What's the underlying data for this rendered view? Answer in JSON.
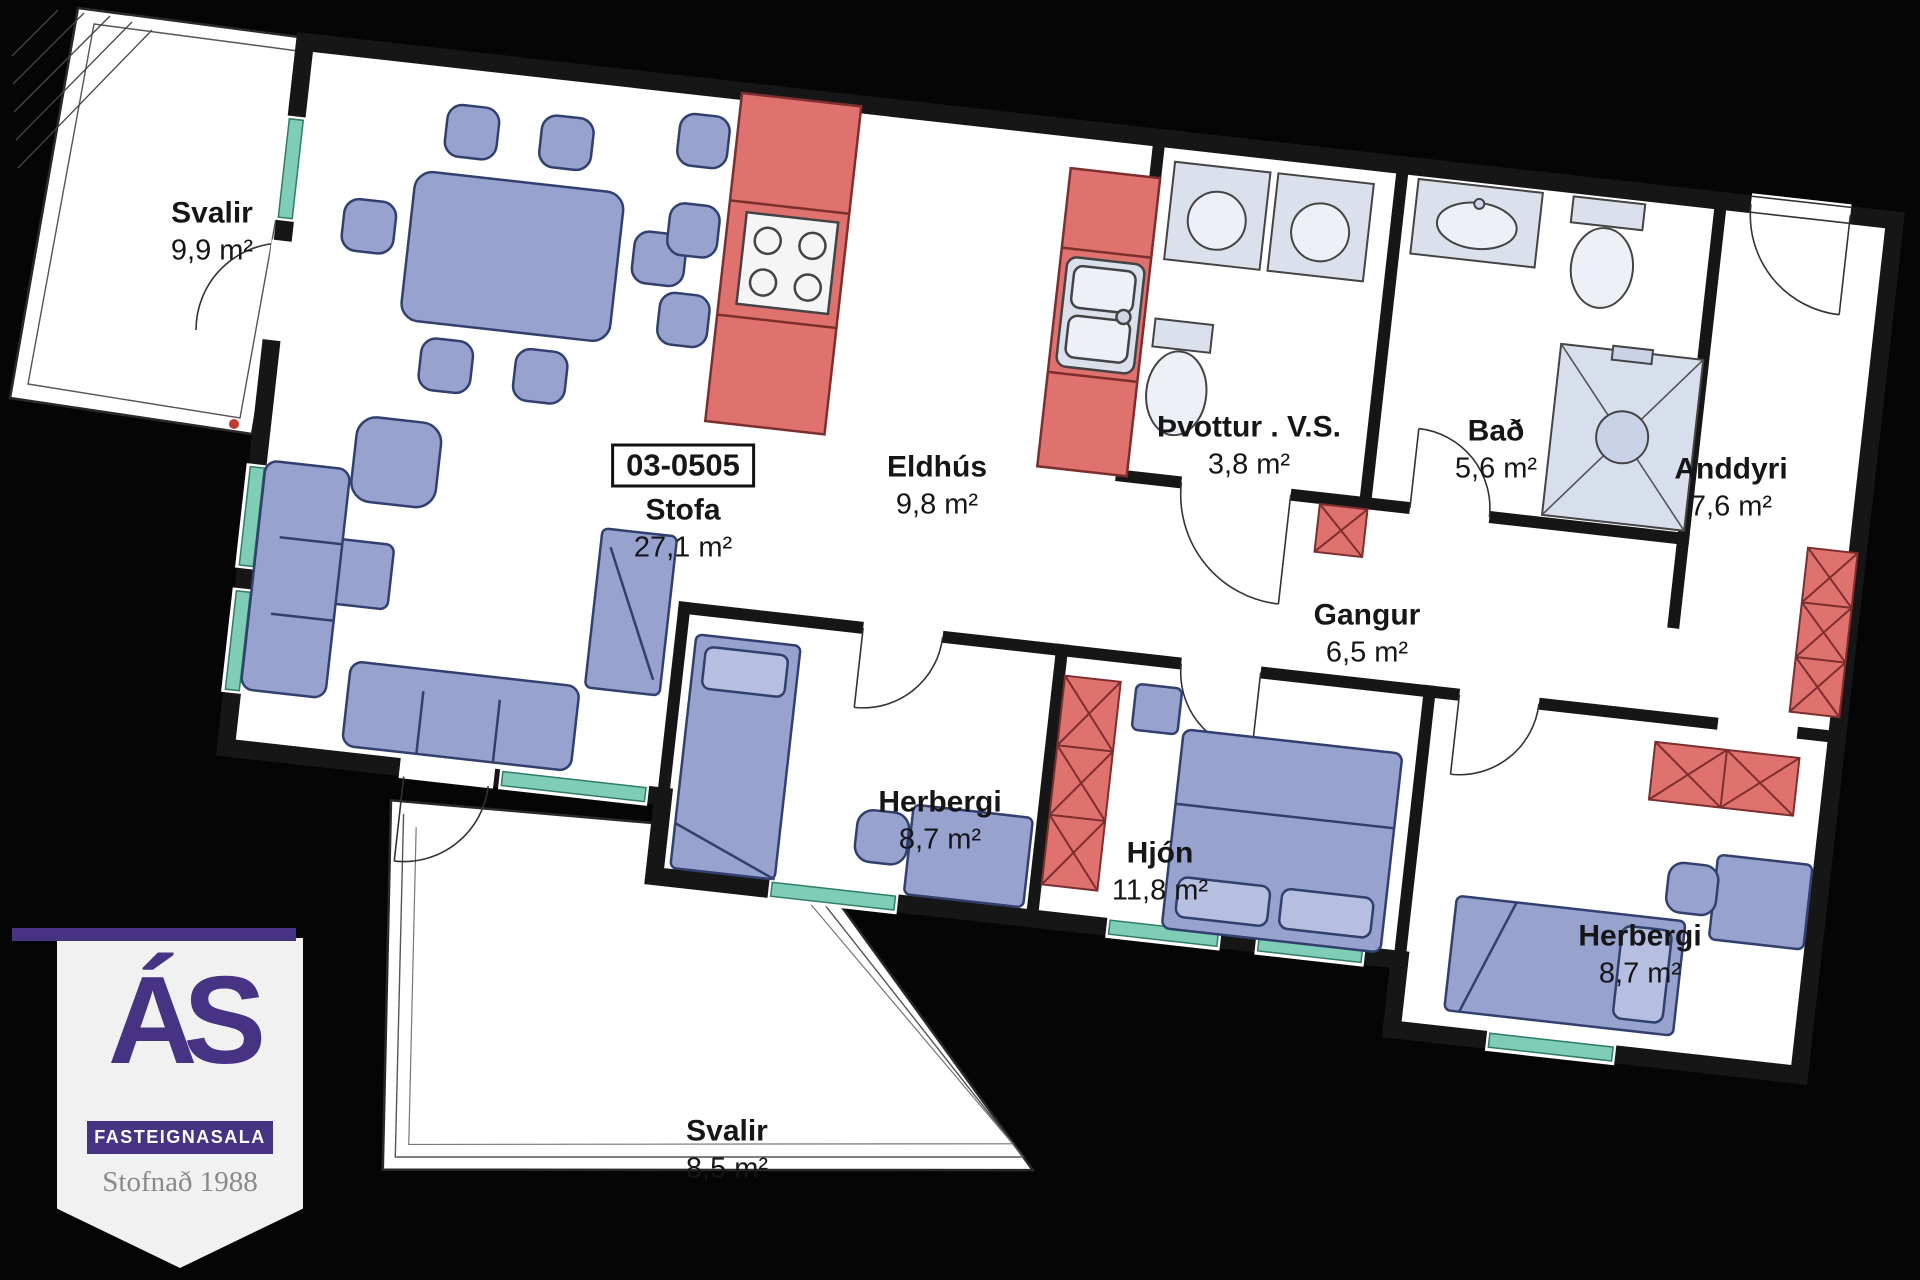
{
  "unit": {
    "number": "03-0505"
  },
  "rooms": [
    {
      "id": "svalir-top",
      "name": "Svalir",
      "area": "9,9 m²"
    },
    {
      "id": "stofa",
      "name": "Stofa",
      "area": "27,1 m²"
    },
    {
      "id": "eldhus",
      "name": "Eldhús",
      "area": "9,8 m²"
    },
    {
      "id": "thvottur",
      "name": "Þvottur . V.S.",
      "area": "3,8 m²"
    },
    {
      "id": "bad",
      "name": "Bað",
      "area": "5,6 m²"
    },
    {
      "id": "anddyri",
      "name": "Anddyri",
      "area": "7,6 m²"
    },
    {
      "id": "gangur",
      "name": "Gangur",
      "area": "6,5 m²"
    },
    {
      "id": "herbergi-mid",
      "name": "Herbergi",
      "area": "8,7 m²"
    },
    {
      "id": "hjon",
      "name": "Hjón",
      "area": "11,8 m²"
    },
    {
      "id": "herbergi-right",
      "name": "Herbergi",
      "area": "8,7 m²"
    },
    {
      "id": "svalir-bottom",
      "name": "Svalir",
      "area": "8,5 m²"
    }
  ],
  "logo": {
    "brand": "ÁS",
    "subtitle": "FASTEIGNASALA",
    "tagline": "Stofnað 1988"
  },
  "colors": {
    "background": "#050505",
    "wall": "#161616",
    "furniture_blue": "#97A2CF",
    "cabinet_red": "#DF716E",
    "sill_teal": "#7FCDB7",
    "fixture_gray": "#DBE0ED",
    "logo_purple": "#473384"
  }
}
